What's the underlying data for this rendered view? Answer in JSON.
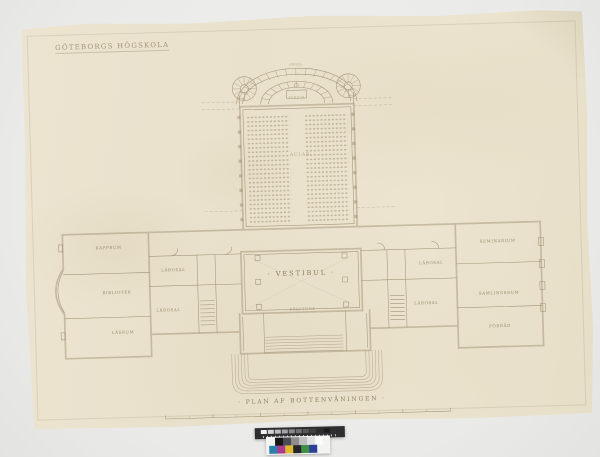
{
  "colors": {
    "background": "#eaeae8",
    "paper": "#eae2cd",
    "ink": "#9b8c6e",
    "title_ink": "#a2947a"
  },
  "paper": {
    "title": "GÖTEBORGS HÖGSKOLA",
    "caption": "· PLAN AF BOTTENVÅNINGEN ·"
  },
  "plan": {
    "hall_label": "· VESTIBUL ·",
    "auditorium_label": "AULAN",
    "apse_labels": [
      "ORGEL",
      "PODIUM"
    ],
    "entry_label": "FÖRSTUGA",
    "rooms": [
      {
        "label": "KAPPRUM",
        "x": 84,
        "y": 226
      },
      {
        "label": "BIBLIOTEK",
        "x": 91,
        "y": 271
      },
      {
        "label": "LÄSRUM",
        "x": 96,
        "y": 311
      },
      {
        "label": "LÄROSAL",
        "x": 148,
        "y": 250
      },
      {
        "label": "LÄROSAL",
        "x": 142,
        "y": 290
      },
      {
        "label": "LÄROSAL",
        "x": 406,
        "y": 250
      },
      {
        "label": "LÄROSAL",
        "x": 400,
        "y": 290
      },
      {
        "label": "SEMINARIUM",
        "x": 473,
        "y": 230
      },
      {
        "label": "SAMLINGSRUM",
        "x": 473,
        "y": 282
      },
      {
        "label": "FÖRRÅD",
        "x": 473,
        "y": 315
      }
    ]
  },
  "color_target": {
    "bar_color": "#2e2e30",
    "gray_steps": [
      "#f2f2f2",
      "#d6d6d6",
      "#bcbcbc",
      "#a3a3a3",
      "#8a8a8a",
      "#717171",
      "#595959",
      "#414141",
      "#2c2c2c",
      "#191919"
    ],
    "gray_patches": [
      "#161616",
      "#4b4b55",
      "#8e8e8e",
      "#bfbfbf",
      "#e0e0e0",
      "#fbfbfb"
    ],
    "color_patches": [
      "#2a80ab",
      "#ab3a93",
      "#dfba2c",
      "#26262a",
      "#3d9045",
      "#2c3e96"
    ]
  }
}
